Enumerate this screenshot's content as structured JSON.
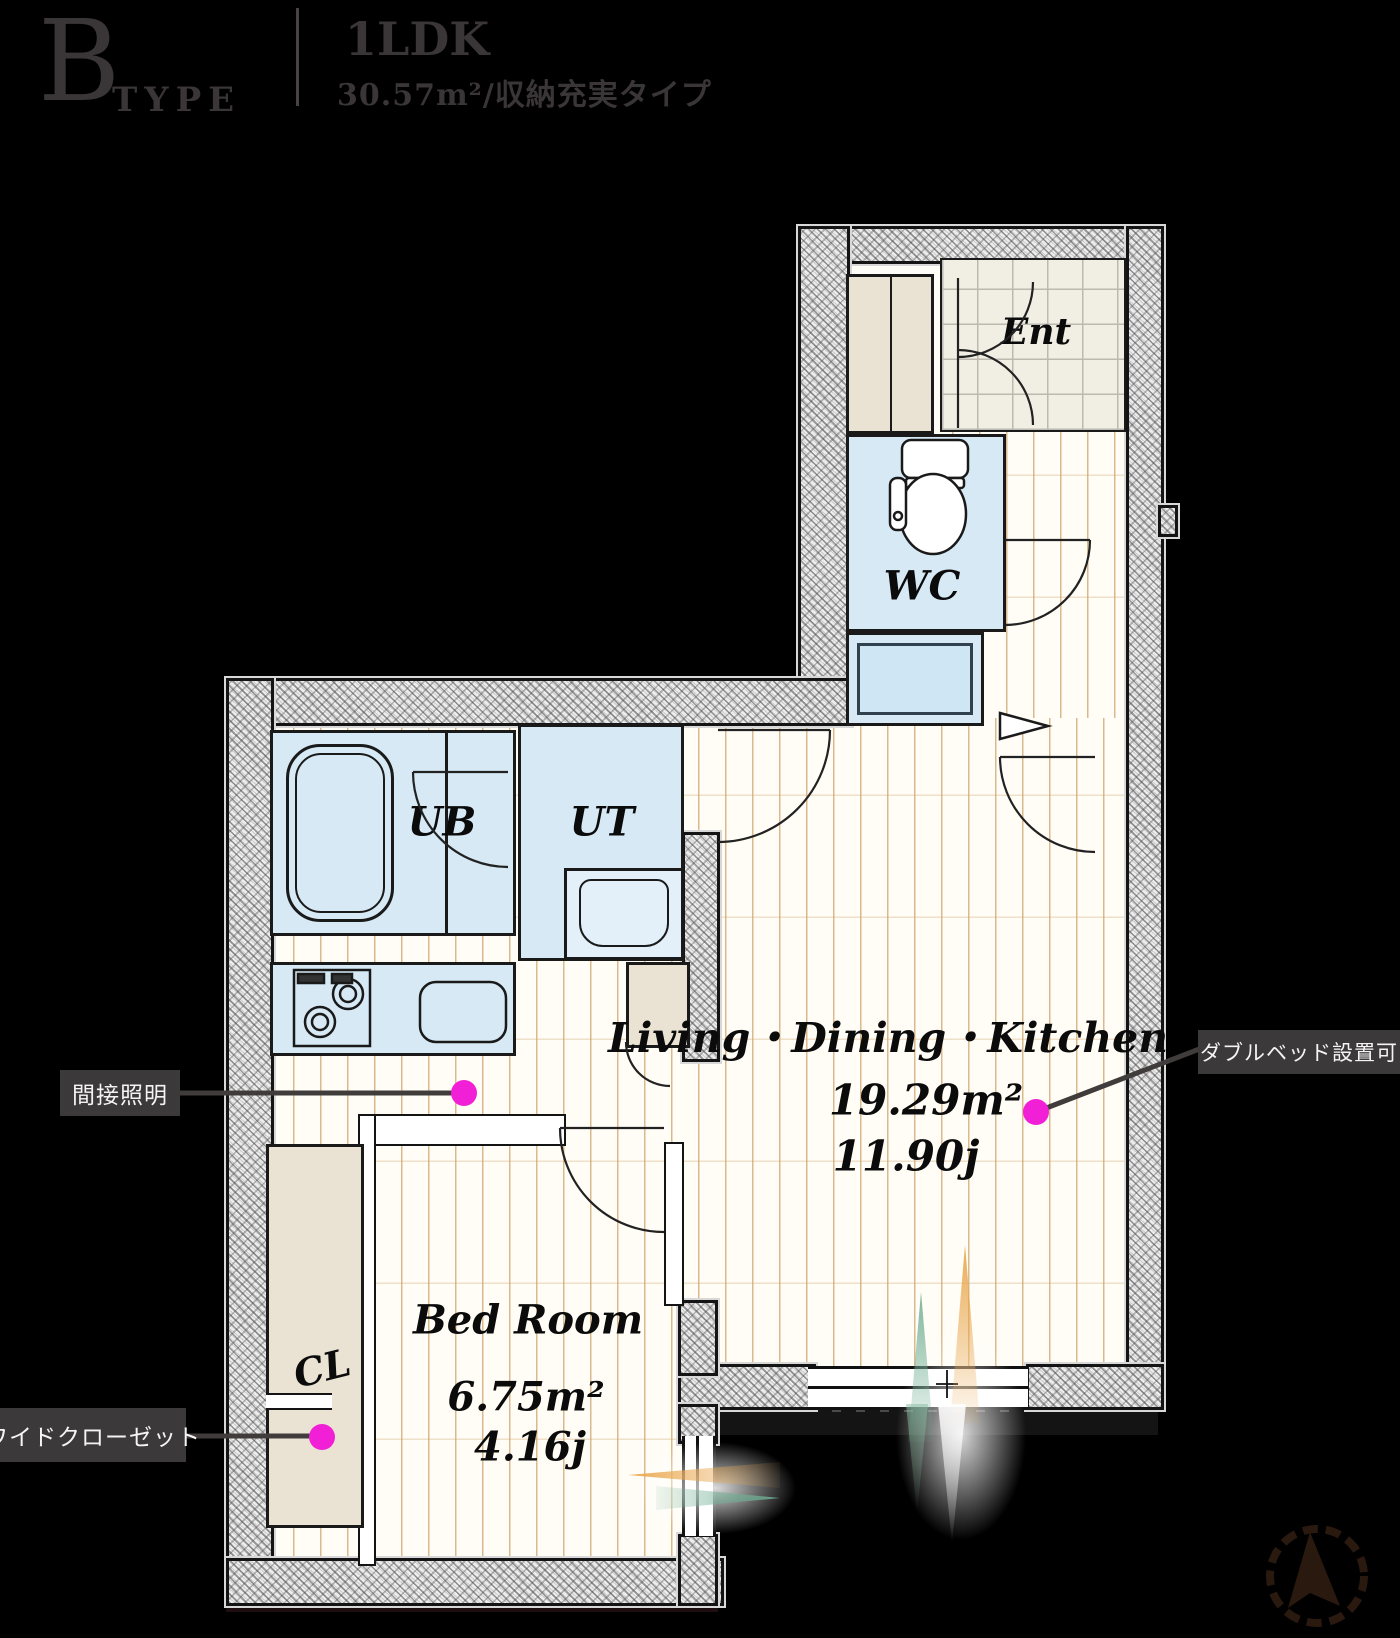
{
  "header": {
    "type_letter": "B",
    "type_word": "TYPE",
    "layout": "1LDK",
    "subtitle": "30.57m²/収納充実タイプ"
  },
  "plan": {
    "rooms": {
      "ent": {
        "label": "Ent"
      },
      "wc": {
        "label": "WC"
      },
      "ub": {
        "label": "UB"
      },
      "ut": {
        "label": "UT"
      },
      "cl": {
        "label": "CL"
      },
      "ldk": {
        "label": "Living・Dining・Kitchen",
        "area_m2": "19.29m²",
        "area_jo": "11.90j"
      },
      "bedroom": {
        "label": "Bed Room",
        "area_m2": "6.75m²",
        "area_jo": "4.16j"
      }
    },
    "callouts": {
      "indirect_lighting": {
        "label": "間接照明"
      },
      "double_bed": {
        "label": "ダブルベッド設置可"
      },
      "wide_closet": {
        "label": "ワイドクローゼット"
      }
    },
    "icons": {
      "compass": "north-compass-icon",
      "toilet": "toilet-icon",
      "bathtub": "bathtub-icon",
      "stove": "stove-icon",
      "sink": "sink-icon",
      "washbasin": "washbasin-icon"
    },
    "colors": {
      "accent_dot": "#f11fd6",
      "wet_area": "#d6e9f5",
      "closet_beige": "#eae3d4",
      "floor_cream": "#fffdf6",
      "plank_line": "#cea26a",
      "callout_bg": "#3b3939",
      "header_text": "#3a3536"
    }
  }
}
